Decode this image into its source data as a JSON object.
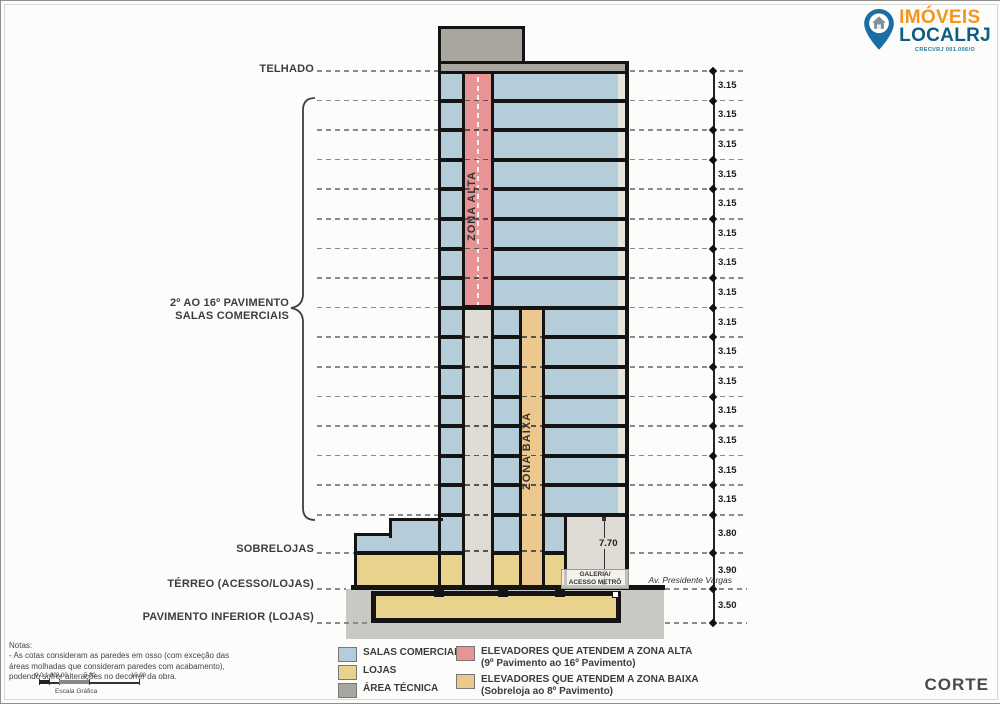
{
  "logo": {
    "imoveis": "IMÓVEIS",
    "localrj": "LOCALRJ",
    "creci": "CRECI/RJ 001.006/O"
  },
  "sheet_title": "CORTE",
  "labels": {
    "telhado": "TELHADO",
    "pavimentos_line1": "2º AO 16º PAVIMENTO",
    "pavimentos_line2": "SALAS COMERCIAIS",
    "sobrelojas": "SOBRELOJAS",
    "terreo": "TÉRREO (ACESSO/LOJAS)",
    "pav_inferior": "PAVIMENTO INFERIOR (LOJAS)"
  },
  "shafts": {
    "zona_alta": "ZONA ALTA",
    "zona_baixa": "ZONA BAIXA"
  },
  "annotations": {
    "galeria_line1": "GALERIA/",
    "galeria_line2": "ACESSO METRÔ",
    "galeria_height": "7.70",
    "street": "Av. Presidente Vargas"
  },
  "dimensions": {
    "values": [
      "3.15",
      "3.15",
      "3.15",
      "3.15",
      "3.15",
      "3.15",
      "3.15",
      "3.15",
      "3.15",
      "3.15",
      "3.15",
      "3.15",
      "3.15",
      "3.15",
      "3.15",
      "3.80",
      "3.90",
      "3.50"
    ]
  },
  "legend": [
    {
      "color": "#b5cdd9",
      "label": "SALAS COMERCIAIS",
      "sub": ""
    },
    {
      "color": "#e9d28c",
      "label": "LOJAS",
      "sub": ""
    },
    {
      "color": "#a9a69f",
      "label": "ÁREA TÉCNICA",
      "sub": ""
    },
    {
      "color": "#e89494",
      "label": "ELEVADORES QUE ATENDEM A ZONA ALTA",
      "sub": "(9º Pavimento ao 16º Pavimento)"
    },
    {
      "color": "#ecc88f",
      "label": "ELEVADORES QUE ATENDEM A ZONA BAIXA",
      "sub": "(Sobreloja ao 8º Pavimento)"
    }
  ],
  "notes": {
    "title": "Notas:",
    "line1": "- As cotas consideram as paredes em osso (com exceção das",
    "line2": "áreas molhadas que consideram paredes com acabamento),",
    "line3": "podendo sofrer alterações no decorrer da obra."
  },
  "scalebar": {
    "ticks": [
      "0.0",
      "1.00",
      "2.00",
      "5.00",
      "10.00"
    ],
    "caption": "Escala Gráfica"
  },
  "colors": {
    "salas": "#b5cdd9",
    "lojas": "#e9d28c",
    "area_tecnica": "#a9a69f",
    "zona_alta": "#e89494",
    "zona_baixa": "#ecc88f",
    "ground": "#cac8c2",
    "galeria": "#dedcd4",
    "line": "#141414"
  }
}
